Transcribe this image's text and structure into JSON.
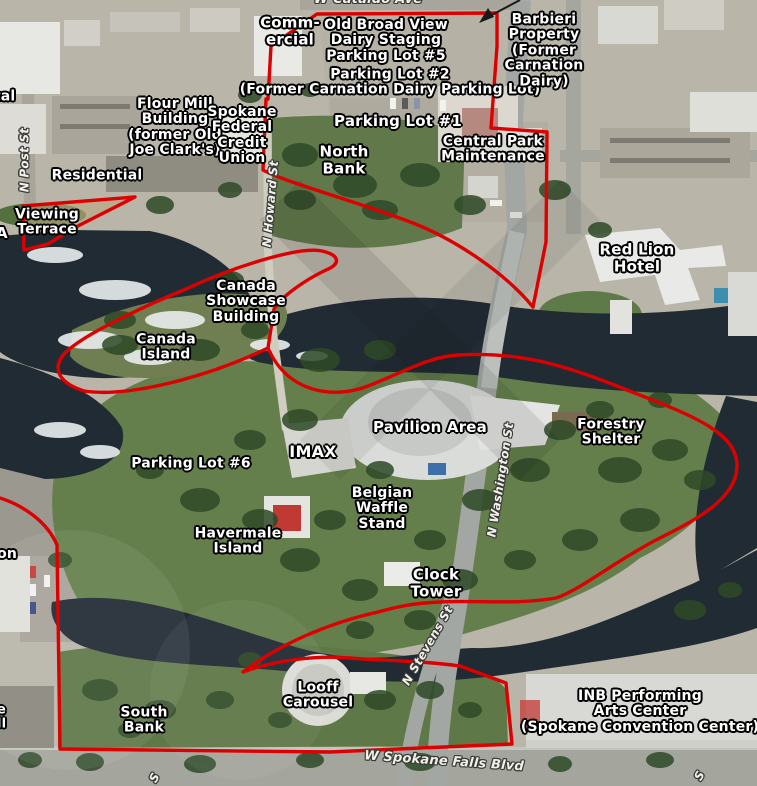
{
  "map": {
    "colors": {
      "boundary": "#dd0000",
      "water": "#212b34",
      "park": "#647f4b",
      "label": "#ffffff",
      "halo": "#000000"
    },
    "labels": [
      {
        "id": "w-cataldo-ave",
        "lines": [
          "W Cataldo Ave"
        ],
        "x": 368,
        "y": 0,
        "size": 13,
        "rotate": 0,
        "kind": "street"
      },
      {
        "id": "commercial",
        "lines": [
          "Comm-",
          "ercial"
        ],
        "x": 290,
        "y": 31,
        "size": 15,
        "kind": "place"
      },
      {
        "id": "old-broad-view-dairy-staging-parking-lot-5",
        "lines": [
          "Old Broad View",
          "Dairy Staging",
          "Parking Lot #5"
        ],
        "x": 386,
        "y": 41,
        "size": 14,
        "kind": "place"
      },
      {
        "id": "parking-lot-2",
        "lines": [
          "Parking Lot #2",
          "(Former Carnation Dairy Parking Lot)"
        ],
        "x": 390,
        "y": 83,
        "size": 14,
        "kind": "place"
      },
      {
        "id": "barbieri-property",
        "lines": [
          "Barbieri",
          "Property",
          "(Former",
          "Carnation",
          "Dairy)"
        ],
        "x": 544,
        "y": 51,
        "size": 14,
        "kind": "place"
      },
      {
        "id": "rental-company-partial",
        "lines": [
          "ental",
          "ny"
        ],
        "x": -26,
        "y": 105,
        "size": 14,
        "kind": "place",
        "align": "left"
      },
      {
        "id": "flour-mill-building",
        "lines": [
          "Flour Mill",
          "Building",
          "(former Old",
          "Joe Clark's)"
        ],
        "x": 175,
        "y": 128,
        "size": 14,
        "kind": "place"
      },
      {
        "id": "spokane-federal-credit-union",
        "lines": [
          "Spokane",
          "Federal",
          "Credit",
          "Union"
        ],
        "x": 242,
        "y": 136,
        "size": 14,
        "kind": "place"
      },
      {
        "id": "parking-lot-1",
        "lines": [
          "Parking Lot #1"
        ],
        "x": 398,
        "y": 121,
        "size": 15,
        "kind": "place"
      },
      {
        "id": "north-bank",
        "lines": [
          "North",
          "Bank"
        ],
        "x": 344,
        "y": 160,
        "size": 15,
        "kind": "place"
      },
      {
        "id": "central-park-maintenance",
        "lines": [
          "Central Park",
          "Maintenance"
        ],
        "x": 493,
        "y": 150,
        "size": 14,
        "kind": "place"
      },
      {
        "id": "residential",
        "lines": [
          "Residential"
        ],
        "x": 97,
        "y": 176,
        "size": 14,
        "kind": "place"
      },
      {
        "id": "n-post-st",
        "lines": [
          "N Post St"
        ],
        "x": 25,
        "y": 160,
        "size": 12,
        "rotate": -90,
        "kind": "street"
      },
      {
        "id": "viewing-terrace",
        "lines": [
          "Viewing",
          "Terrace"
        ],
        "x": 47,
        "y": 223,
        "size": 14,
        "kind": "place"
      },
      {
        "id": "a-partial",
        "lines": [
          "A"
        ],
        "x": -4,
        "y": 233,
        "size": 15,
        "kind": "place",
        "align": "left"
      },
      {
        "id": "red-lion-hotel",
        "lines": [
          "Red Lion",
          "Hotel"
        ],
        "x": 637,
        "y": 258,
        "size": 15,
        "kind": "place"
      },
      {
        "id": "n-howard-st",
        "lines": [
          "N Howard St"
        ],
        "x": 271,
        "y": 204,
        "size": 12,
        "rotate": -85,
        "kind": "street"
      },
      {
        "id": "canada-showcase-building",
        "lines": [
          "Canada",
          "Showcase",
          "Building"
        ],
        "x": 246,
        "y": 302,
        "size": 14,
        "kind": "place"
      },
      {
        "id": "canada-island",
        "lines": [
          "Canada",
          "Island"
        ],
        "x": 166,
        "y": 348,
        "size": 14,
        "kind": "place"
      },
      {
        "id": "pavilion-area",
        "lines": [
          "Pavilion Area"
        ],
        "x": 430,
        "y": 427,
        "size": 15,
        "kind": "place"
      },
      {
        "id": "forestry-shelter",
        "lines": [
          "Forestry",
          "Shelter"
        ],
        "x": 611,
        "y": 433,
        "size": 14,
        "kind": "place"
      },
      {
        "id": "imax",
        "lines": [
          "IMAX"
        ],
        "x": 313,
        "y": 452,
        "size": 16,
        "kind": "place"
      },
      {
        "id": "parking-lot-6",
        "lines": [
          "Parking Lot #6"
        ],
        "x": 191,
        "y": 464,
        "size": 14,
        "kind": "place"
      },
      {
        "id": "belgian-waffle-stand",
        "lines": [
          "Belgian",
          "Waffle",
          "Stand"
        ],
        "x": 382,
        "y": 509,
        "size": 14,
        "kind": "place"
      },
      {
        "id": "n-washington-st",
        "lines": [
          "N Washington St"
        ],
        "x": 501,
        "y": 480,
        "size": 12,
        "rotate": -81,
        "kind": "street"
      },
      {
        "id": "havermale-island",
        "lines": [
          "Havermale",
          "Island"
        ],
        "x": 238,
        "y": 542,
        "size": 14,
        "kind": "place"
      },
      {
        "id": "clock-tower",
        "lines": [
          "Clock",
          "Tower"
        ],
        "x": 436,
        "y": 583,
        "size": 15,
        "kind": "place"
      },
      {
        "id": "washington-partial",
        "lines": [
          "gton",
          "er",
          "er"
        ],
        "x": -20,
        "y": 570,
        "size": 14,
        "kind": "place",
        "align": "left"
      },
      {
        "id": "n-stevens-st",
        "lines": [
          "N Stevens St"
        ],
        "x": 428,
        "y": 646,
        "size": 12,
        "rotate": -60,
        "kind": "street"
      },
      {
        "id": "looff-carousel",
        "lines": [
          "Looff",
          "Carousel"
        ],
        "x": 318,
        "y": 696,
        "size": 14,
        "kind": "place"
      },
      {
        "id": "south-bank",
        "lines": [
          "South",
          "Bank"
        ],
        "x": 144,
        "y": 721,
        "size": 14,
        "kind": "place"
      },
      {
        "id": "inb-performing-arts-center",
        "lines": [
          "INB Performing",
          "Arts Center",
          "(Spokane Convention Center)"
        ],
        "x": 640,
        "y": 712,
        "size": 14,
        "kind": "place"
      },
      {
        "id": "partial-e-ll",
        "lines": [
          "e",
          "ll"
        ],
        "x": -3,
        "y": 718,
        "size": 13,
        "kind": "place",
        "align": "left"
      },
      {
        "id": "w-spokane-falls-blvd",
        "lines": [
          "W Spokane Falls Blvd"
        ],
        "x": 444,
        "y": 762,
        "size": 13,
        "rotate": 4,
        "kind": "street"
      },
      {
        "id": "s-street-partial-left",
        "lines": [
          "S"
        ],
        "x": 155,
        "y": 778,
        "size": 12,
        "rotate": -60,
        "kind": "street"
      },
      {
        "id": "s-street-partial-right",
        "lines": [
          "S"
        ],
        "x": 700,
        "y": 776,
        "size": 12,
        "rotate": -60,
        "kind": "street"
      }
    ]
  }
}
